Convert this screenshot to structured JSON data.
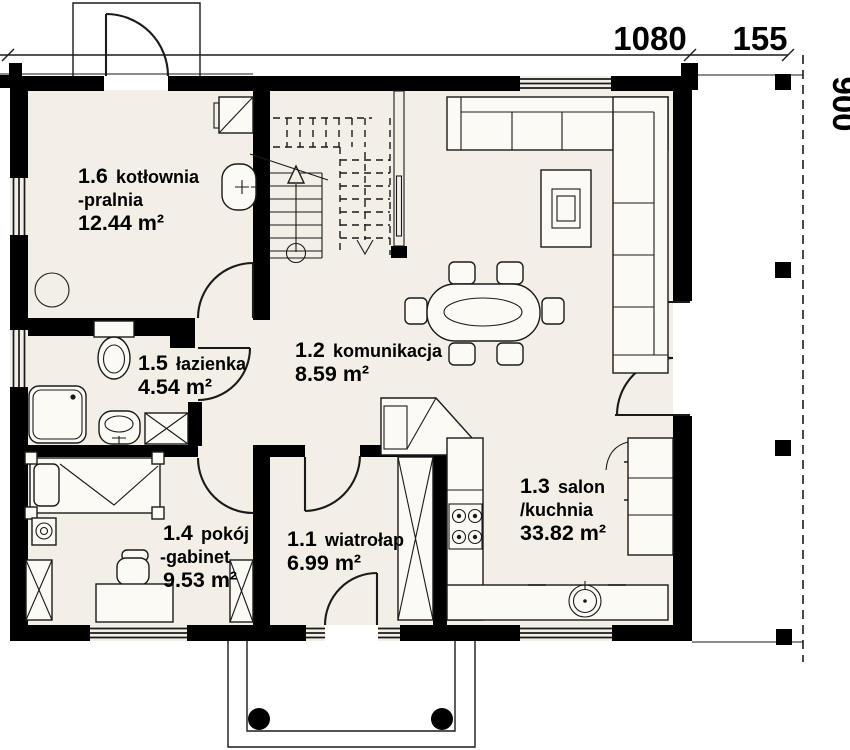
{
  "theme": {
    "background": "#ffffff",
    "floor": "#f3efe7",
    "wall": "#000000",
    "line": "#1a1a1a",
    "furniture_fill": "#fcfaf5"
  },
  "plan": {
    "type": "floor-plan",
    "rooms": [
      {
        "id": "1.1",
        "name": "wiatrołap",
        "area": "6.99 m²"
      },
      {
        "id": "1.2",
        "name": "komunikacja",
        "area": "8.59 m²"
      },
      {
        "id": "1.3",
        "name": "salon",
        "name2": "/kuchnia",
        "area": "33.82 m²"
      },
      {
        "id": "1.4",
        "name": "pokój",
        "name2": "-gabinet",
        "area": "9.53 m²"
      },
      {
        "id": "1.5",
        "name": "łazienka",
        "area": "4.54 m²"
      },
      {
        "id": "1.6",
        "name": "kotłownia",
        "name2": "-pralnia",
        "area": "12.44 m²"
      }
    ],
    "dimensions": {
      "top_main": "1080",
      "top_terrace": "155",
      "side": "900"
    },
    "symbols": {
      "staircase": "svg-lines-with-dashed-upper-flight-and-arrows",
      "corner-sofa": "svg-rect-sections",
      "coffee-table": "svg-nested-rects",
      "dining-table": "svg-rounded-rect-with-oval",
      "chair": "svg-rounded-rect",
      "kitchen-counter": "svg-rects",
      "stove": "svg-four-burner-circles",
      "kitchen-sink": "svg-circle-with-tap",
      "tall-cabinet-fridge": "svg-rect-with-door-arc",
      "bed": "svg-rect-with-pillow-and-corner-posts",
      "desk": "svg-rect",
      "office-chair": "svg-rounded-rects",
      "wardrobe": "svg-rect-with-x",
      "shaft": "svg-rect-with-x",
      "shower": "svg-rounded-square-with-drain",
      "toilet": "svg-tank-and-bowl",
      "washbasin": "svg-rounded-rect-with-tap",
      "washing-machine": "svg-rect-with-x",
      "boiler": "svg-square-with-diagonal",
      "floor-drain": "svg-circle",
      "door-swing": "svg-quarter-arc",
      "window": "svg-triple-line",
      "column": "svg-black-square-or-circle"
    }
  }
}
